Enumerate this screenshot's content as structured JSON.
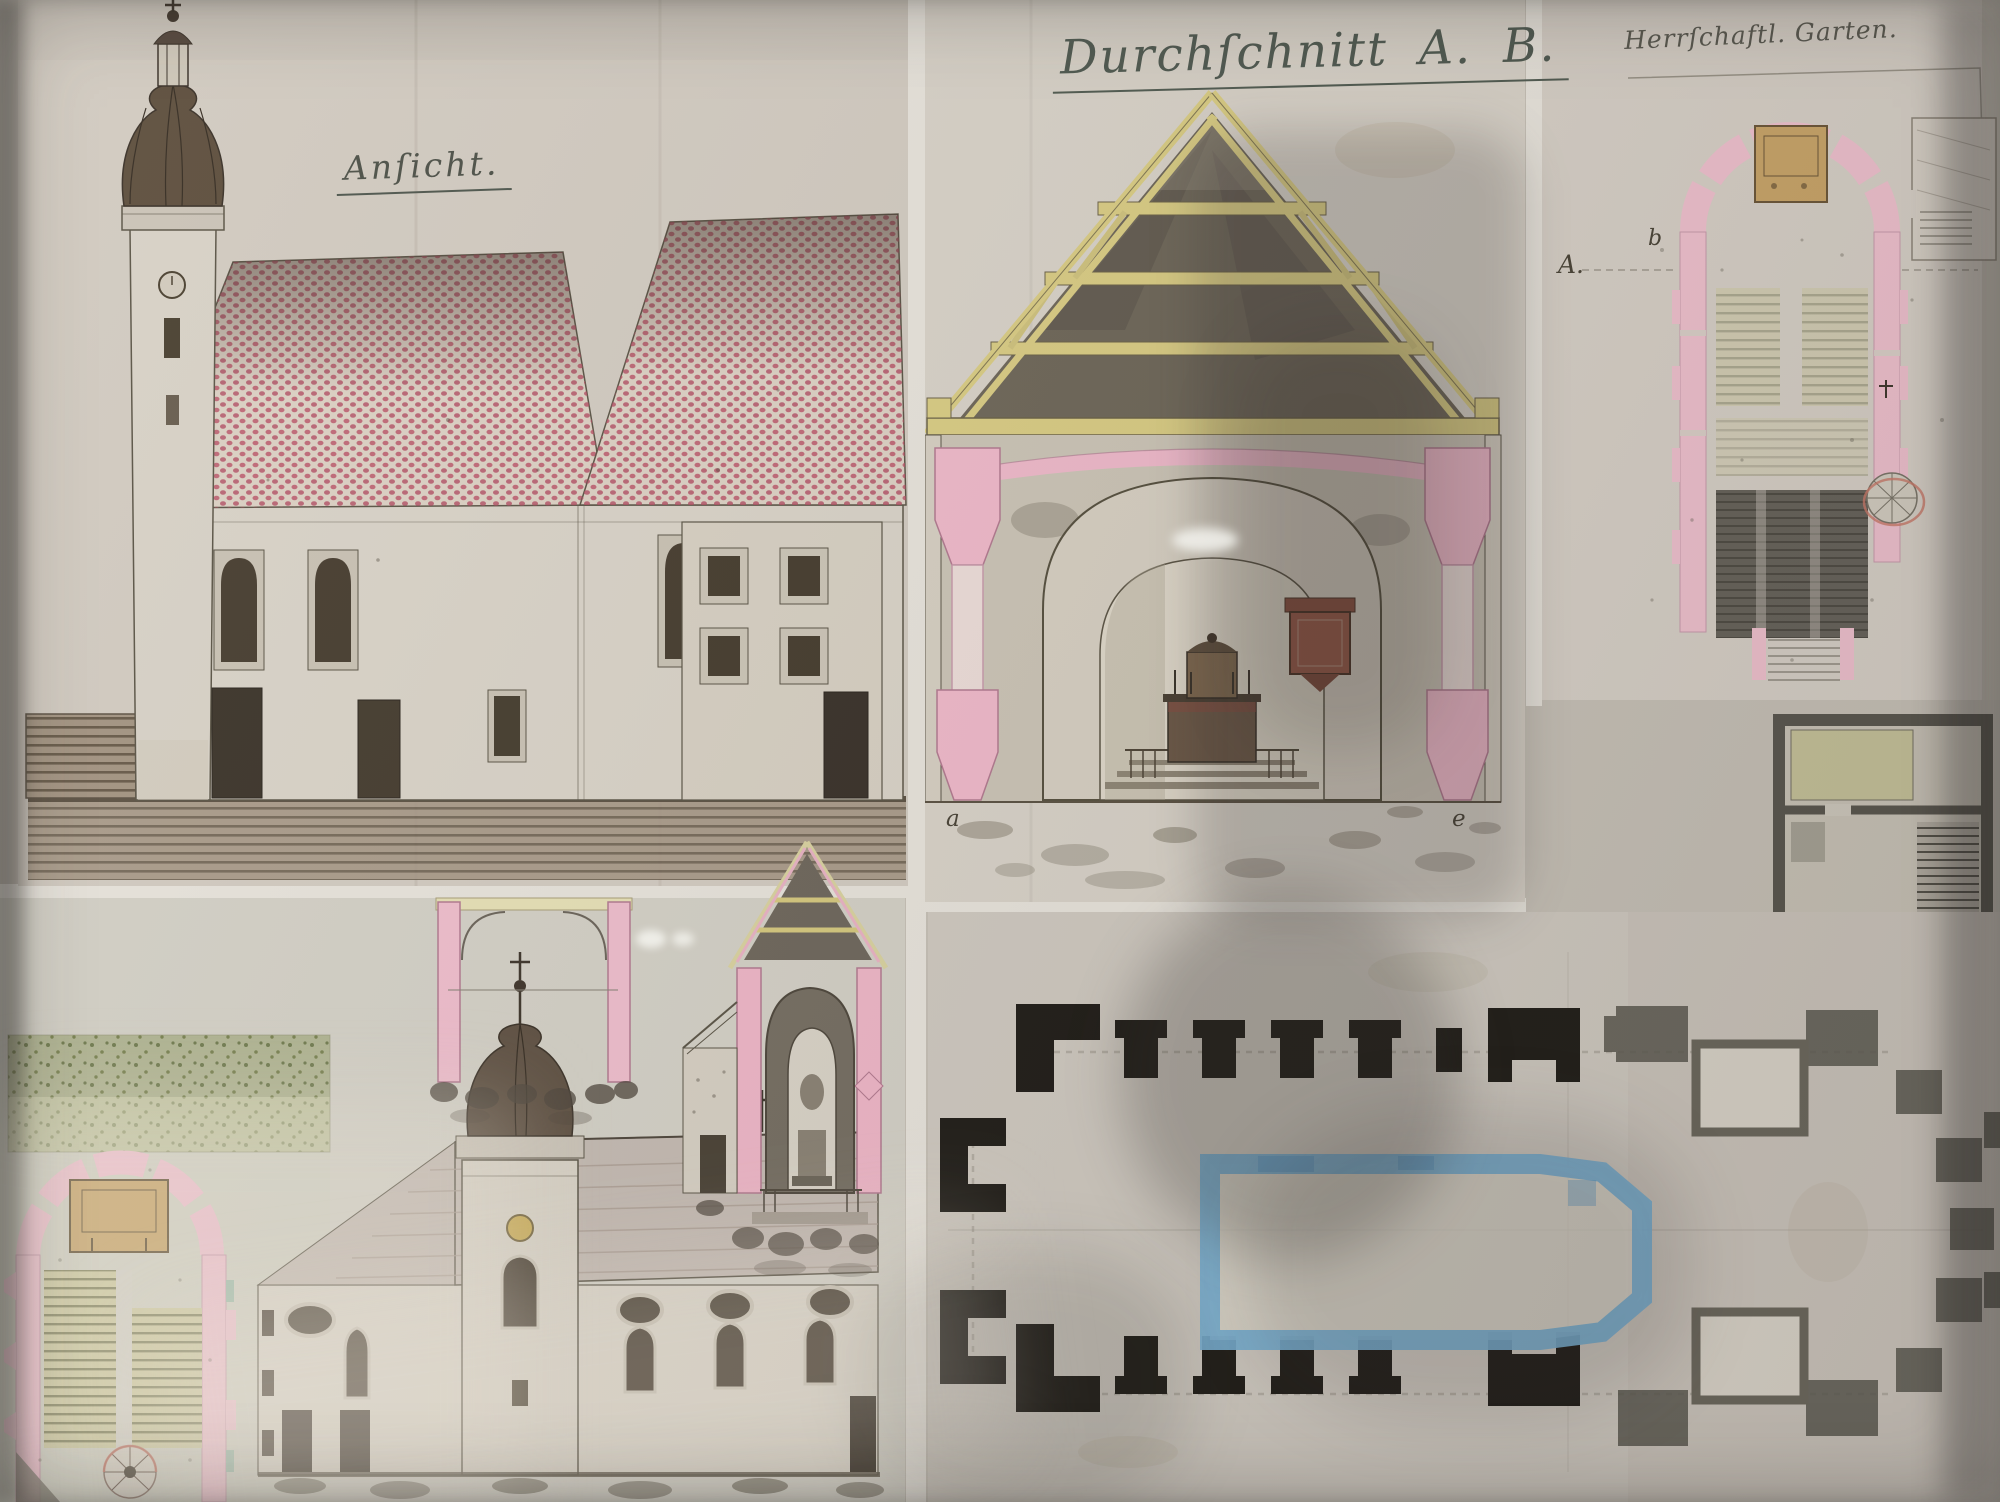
{
  "labels": {
    "elevation_title": "Anſicht.",
    "section_title": "Durchſchnitt A. B.",
    "garden_plan_title": "Herrſchaftl. Garten.",
    "section_col_left": "a",
    "section_col_right": "e",
    "garden_plan_section_letter": "A.",
    "garden_plan_note": "b"
  },
  "palette": {
    "paper": "#d6cfc5",
    "roof_red": "#b95065",
    "wall_pink": "#eeb9ca",
    "timber_yellow": "#d9cc84",
    "plan_ink_black": "#211e19",
    "plan_ink_gray": "#5b584f",
    "plan_blue": "#79b1d4",
    "sepia_ink": "#4a4437",
    "garden_green": "#8f9a6b"
  }
}
